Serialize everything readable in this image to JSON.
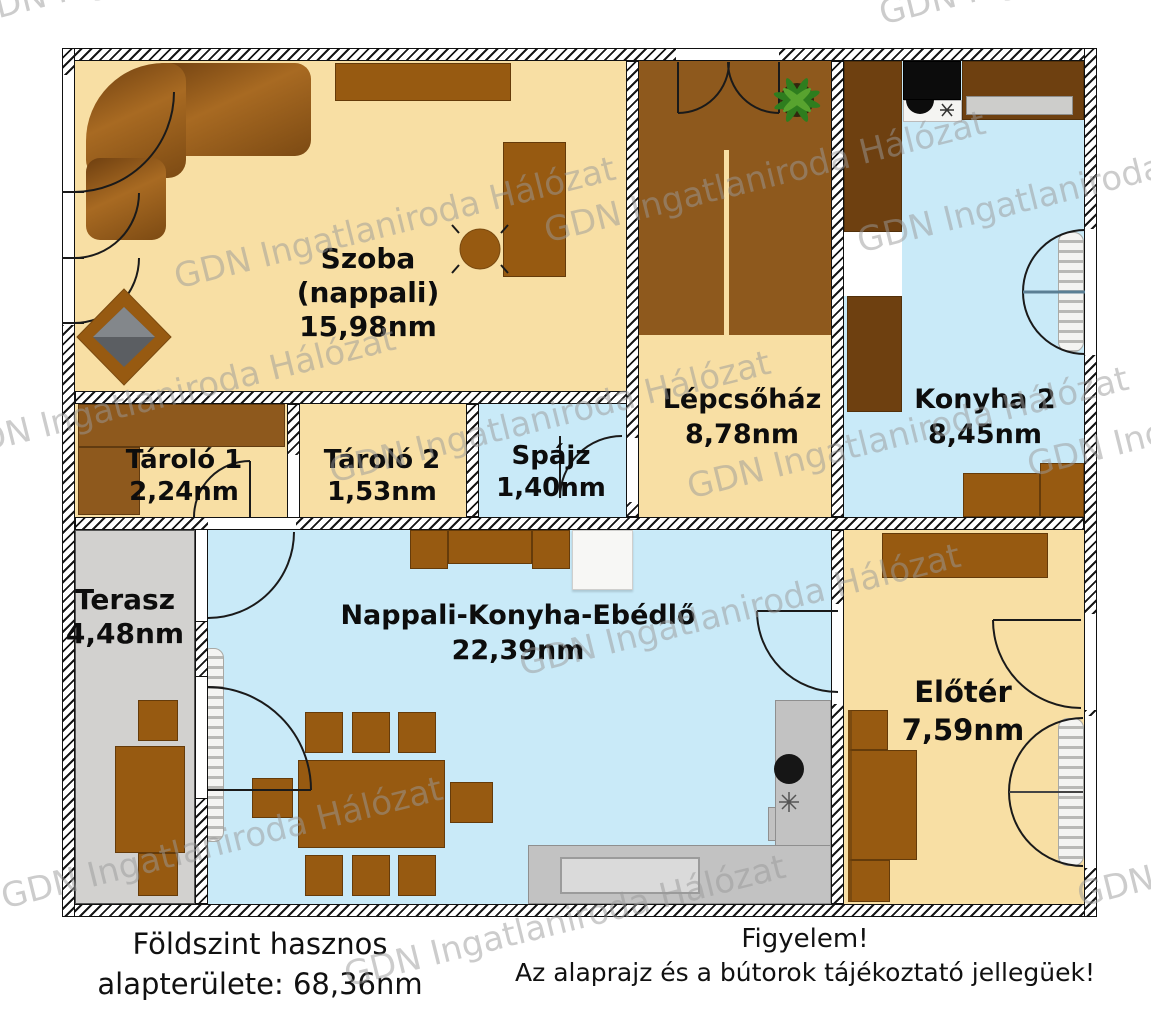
{
  "watermark": {
    "text": "GDN Ingatlaniroda Hálózat"
  },
  "rooms": [
    {
      "id": "szoba",
      "name": "Szoba",
      "sub": "(nappali)",
      "area": "15,98nm"
    },
    {
      "id": "tarolo1",
      "name": "Tároló 1",
      "area": "2,24nm"
    },
    {
      "id": "tarolo2",
      "name": "Tároló 2",
      "area": "1,53nm"
    },
    {
      "id": "spajz",
      "name": "Spájz",
      "area": "1,40nm"
    },
    {
      "id": "lepcsohaz",
      "name": "Lépcsőház",
      "area": "8,78nm"
    },
    {
      "id": "konyha2",
      "name": "Konyha 2",
      "area": "8,45nm"
    },
    {
      "id": "terasz",
      "name": "Terasz",
      "area": "4,48nm"
    },
    {
      "id": "nappali",
      "name": "Nappali-Konyha-Ebédlő",
      "area": "22,39nm"
    },
    {
      "id": "eloter",
      "name": "Előtér",
      "area": "7,59nm"
    }
  ],
  "footer": {
    "left_line1": "Földszint hasznos",
    "left_line2": "alapterülete: 68,36nm",
    "right_line1": "Figyelem!",
    "right_line2": "Az alaprajz és a bútorok tájékoztató jellegüek!"
  },
  "colors": {
    "cream": "#F8DFA4",
    "blue": "#C9EAF8",
    "terrace": "#D2D1CF",
    "brown": "#975A11",
    "darkbrown": "#6E4010",
    "stairs": "#8E591D",
    "counter": "#C2C2C2",
    "watermark": "#9a9a9a"
  }
}
